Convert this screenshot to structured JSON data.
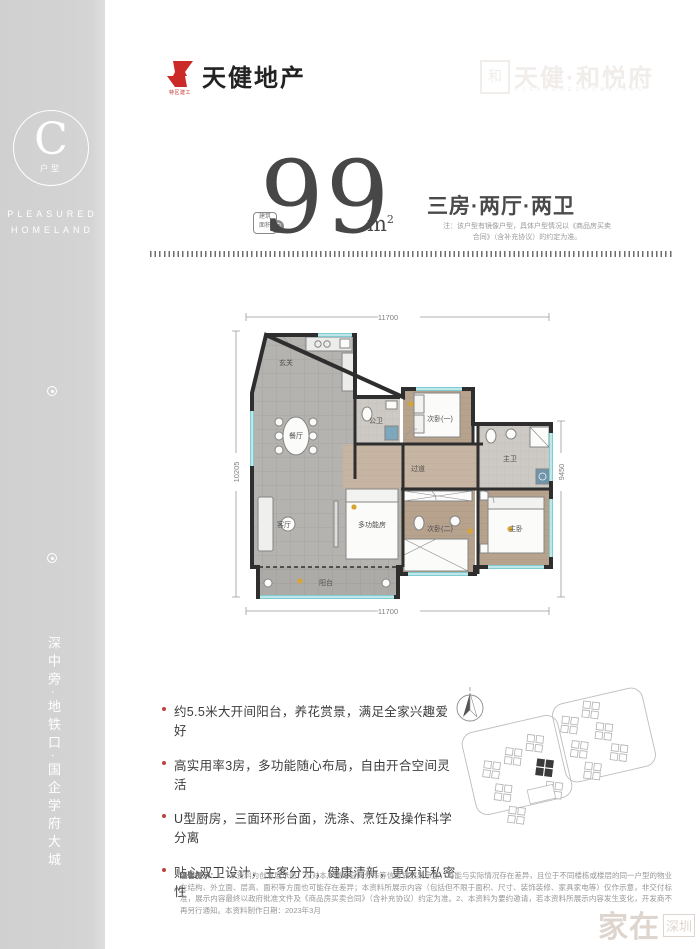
{
  "brand": {
    "logo_text": "天健地产",
    "logo_sub": "特区建工",
    "accent_red": "#cb2a28"
  },
  "watermark_top": {
    "box_glyph": "和",
    "title": "天健·和悦府",
    "subtitle": "P L E A S U R E D  H O M E L A N D"
  },
  "sidebar": {
    "unit_letter": "C",
    "unit_label": "户型",
    "english_line1": "PLEASURED",
    "english_line2": "HOMELAND",
    "vertical_title": "户型鉴赏",
    "vertical_slogan": "深中旁·地铁口·国企学府大城"
  },
  "headline": {
    "badge_line1": "建筑",
    "badge_line2": "面积",
    "badge_circle": "约",
    "area_value": "99",
    "area_unit": "m",
    "area_unit_sup": "2",
    "layout_text": "三房·两厅·两卫",
    "note_line1": "注：该户型有镜像户型，具体户型情况以《商品房买卖",
    "note_line2": "合同》（含补充协议）的约定为准。"
  },
  "plan": {
    "dim_top": "11700",
    "dim_bottom": "11700",
    "dim_left": "10205",
    "dim_right": "9450",
    "wall_color": "#2e2e2e",
    "window_color": "#7fcdd0",
    "rooms": [
      {
        "label": "玄关"
      },
      {
        "label": "餐厅"
      },
      {
        "label": "客厅"
      },
      {
        "label": "多功能房"
      },
      {
        "label": "阳台"
      },
      {
        "label": "公卫"
      },
      {
        "label": "次卧(一)"
      },
      {
        "label": "过道"
      },
      {
        "label": "次卧(二)"
      },
      {
        "label": "主卫"
      },
      {
        "label": "主卧"
      }
    ]
  },
  "highlights": {
    "items": [
      "约5.5米大开间阳台，养花赏景，满足全家兴趣爱好",
      "高实用率3房，多功能随心布局，自由开合空间灵活",
      "U型厨房，三面环形台面，洗涤、烹饪及操作科学分离",
      "贴心双卫设计，主客分开，健康清新，更保证私密性"
    ]
  },
  "disclaimer": {
    "label": "温馨提示：",
    "text": "1、本资料为创意展示图，仅对本户型的空间分布等信息做效果示意，可能与实际情况存在差异，且位于不同楼栋或楼层的同一户型的物业在结构、外立面、层高、面积等方面也可能存在差异；本资料所展示内容（包括但不限于面积、尺寸、装饰装修、家具家电等）仅作示意，非交付标准，展示内容最终以政府批准文件及《商品房买卖合同》（含补充协议）约定为准。2、本资料为要约邀请，若本资料所展示内容发生变化，开发商不再另行通知。本资料制作日期：2023年3月"
  },
  "watermark_bottom": {
    "big": "家在",
    "small": "深圳"
  }
}
